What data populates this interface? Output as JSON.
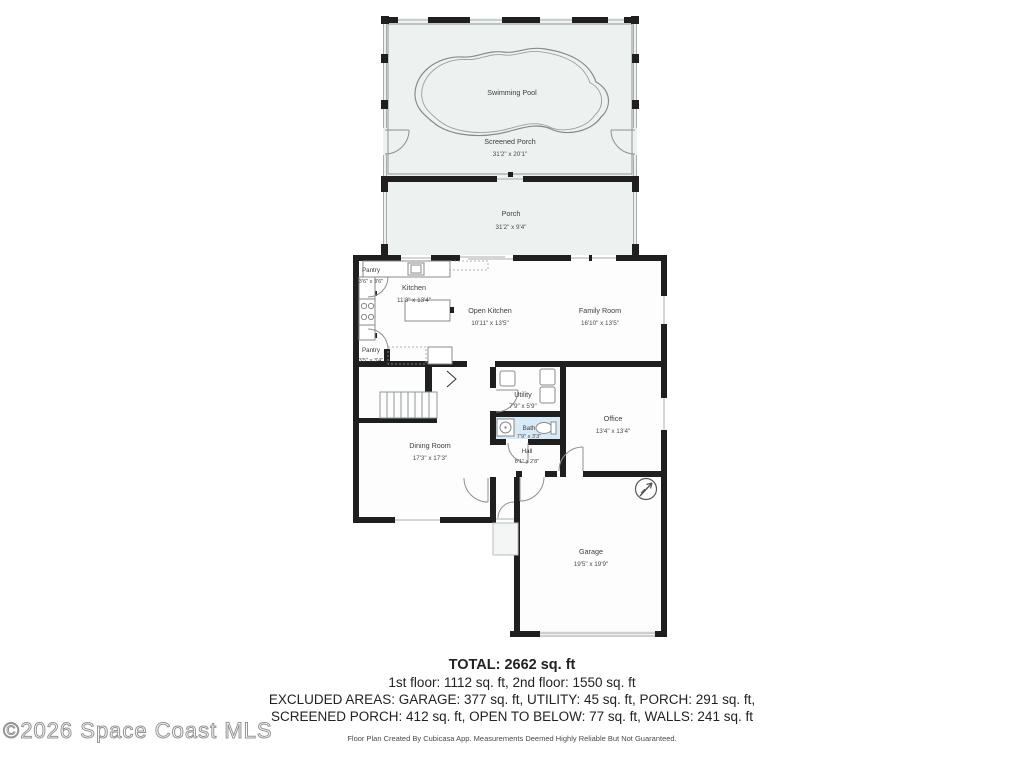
{
  "rooms": [
    {
      "name": "Swimming Pool",
      "dims": ""
    },
    {
      "name": "Screened Porch",
      "dims": "31'2\" x 20'1\""
    },
    {
      "name": "Porch",
      "dims": "31'2\" x 9'4\""
    },
    {
      "name": "Pantry",
      "dims": "3'6\" x 3'6\""
    },
    {
      "name": "Kitchen",
      "dims": "11'3\" x 13'4\""
    },
    {
      "name": "Open Kitchen",
      "dims": "10'11\" x 13'5\""
    },
    {
      "name": "Family Room",
      "dims": "16'10\" x 13'5\""
    },
    {
      "name": "Pantry",
      "dims": "3'5\" x 3'4\""
    },
    {
      "name": "Utility",
      "dims": "7'9\" x 5'9\""
    },
    {
      "name": "Bath",
      "dims": "7'9\" x 3'3\""
    },
    {
      "name": "Office",
      "dims": "13'4\" x 13'4\""
    },
    {
      "name": "Dining Room",
      "dims": "17'3\" x 17'3\""
    },
    {
      "name": "Hall",
      "dims": "8'1\" x 2'8\""
    },
    {
      "name": "Garage",
      "dims": "19'5\" x 19'9\""
    }
  ],
  "footer": {
    "total": "TOTAL: 2662 sq. ft",
    "floors": "1st floor: 1112 sq. ft, 2nd floor: 1550 sq. ft",
    "excluded_line1": "EXCLUDED AREAS: GARAGE: 377 sq. ft, UTILITY: 45 sq. ft, PORCH: 291 sq. ft,",
    "excluded_line2": "SCREENED PORCH: 412 sq. ft, OPEN TO BELOW: 77 sq. ft, WALLS: 241 sq. ft",
    "disclaimer": "Floor Plan Created By Cubicasa App. Measurements Deemed Highly Reliable But Not Guaranteed."
  },
  "watermark": "©2026 Space Coast MLS",
  "icons": {
    "compass": "north-arrow"
  },
  "colors": {
    "porch_fill": "#edf2f1",
    "bath_fill": "#d7eaf5",
    "wall": "#1f1f1f",
    "label": "#3d3d3d",
    "thin_line": "#8f9694"
  }
}
